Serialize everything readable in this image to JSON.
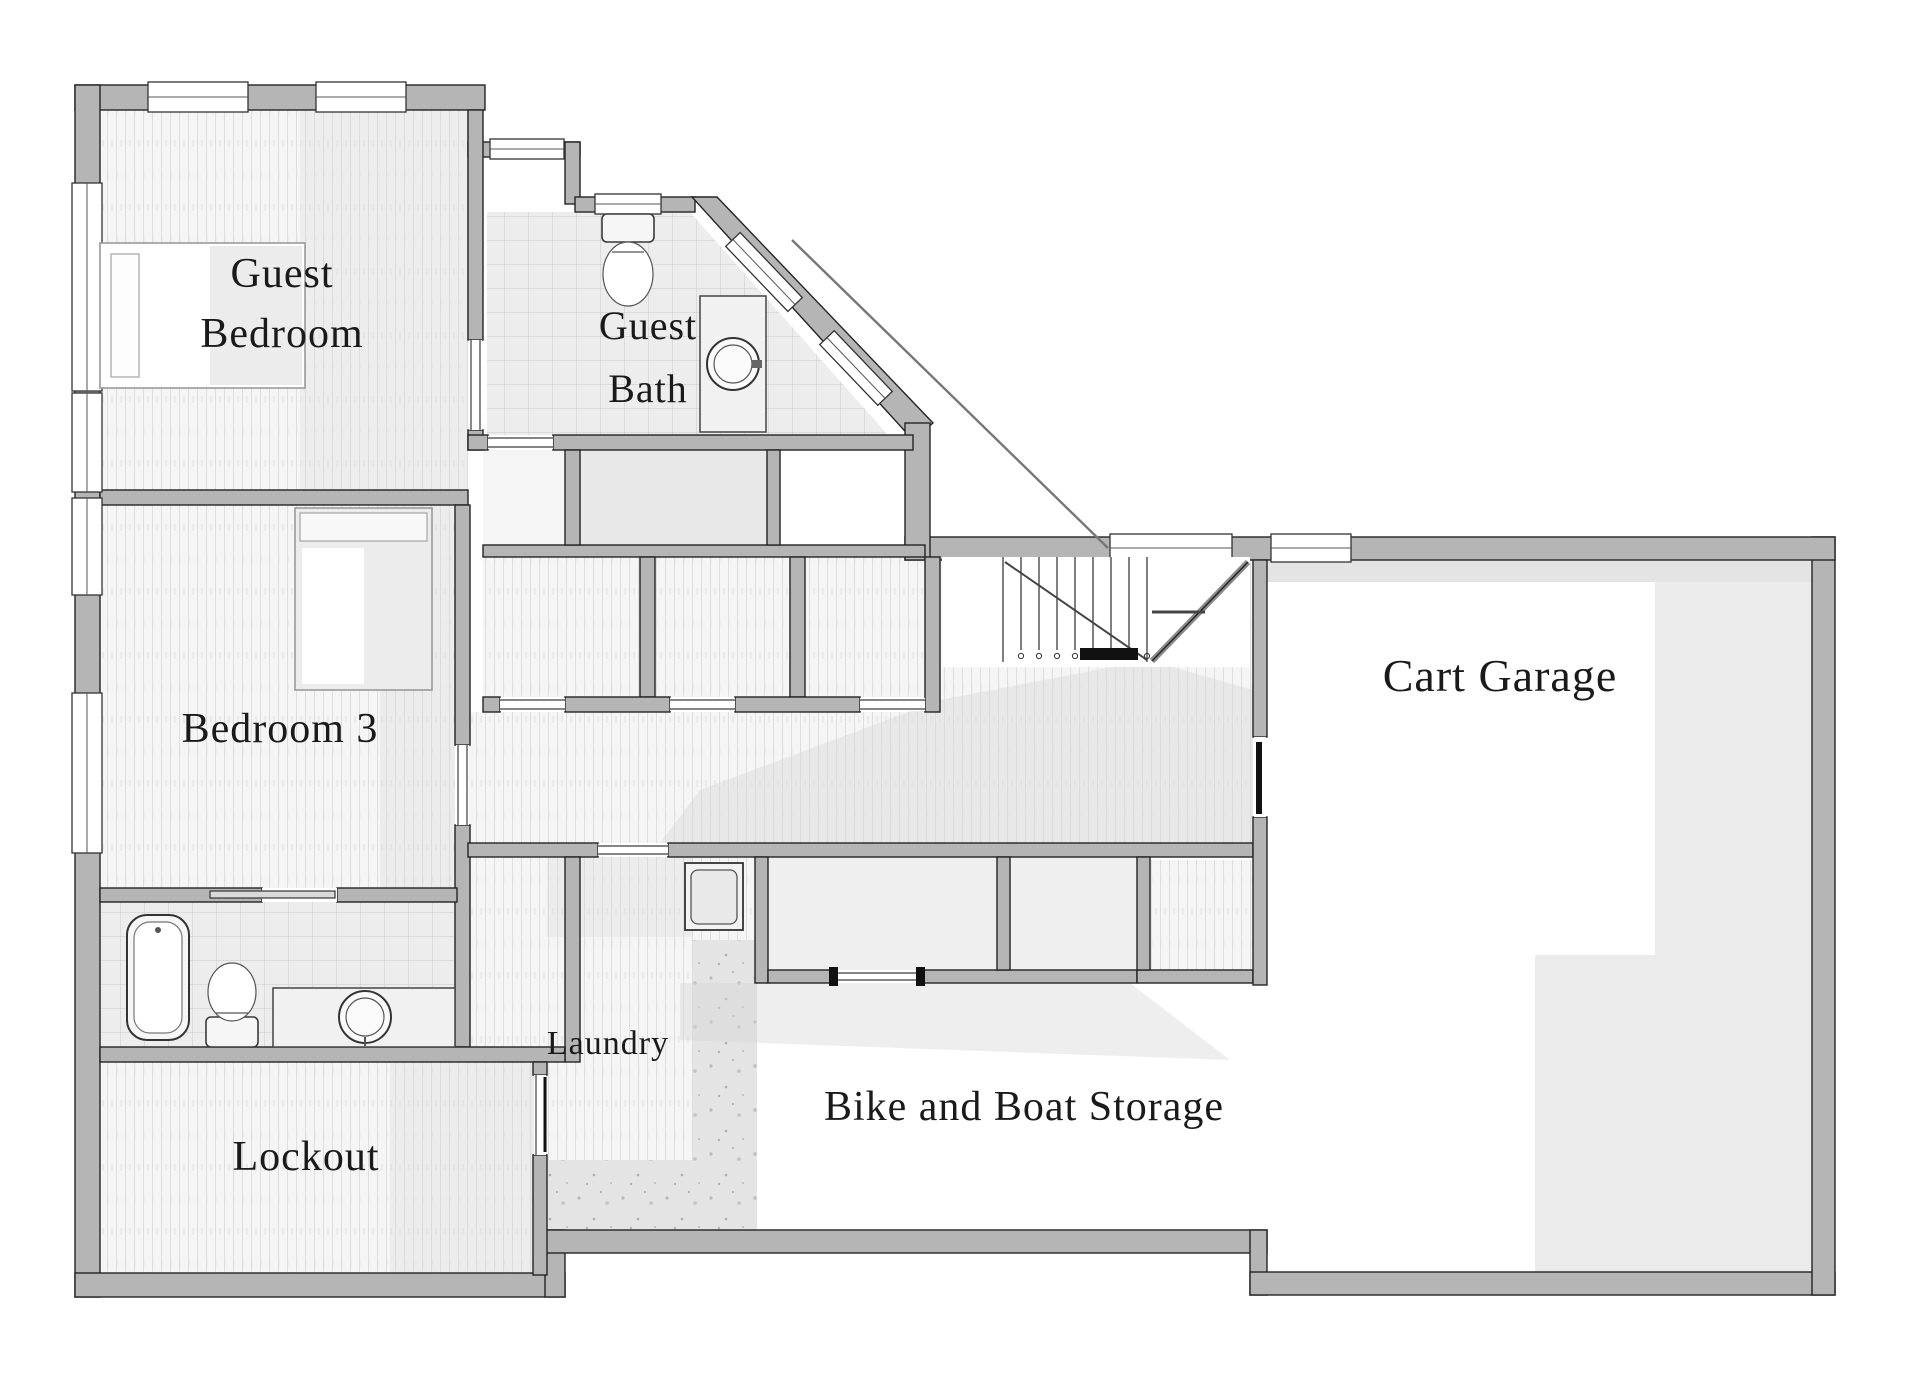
{
  "plan": {
    "type": "floor-plan",
    "level": "lower-level"
  },
  "rooms": {
    "guest_bedroom": {
      "label_line1": "Guest",
      "label_line2": "Bedroom"
    },
    "guest_bath": {
      "label_line1": "Guest",
      "label_line2": "Bath"
    },
    "bedroom_3": {
      "label": "Bedroom 3"
    },
    "lockout": {
      "label": "Lockout"
    },
    "laundry": {
      "label": "Laundry"
    },
    "bike_boat_storage": {
      "label": "Bike and Boat Storage"
    },
    "cart_garage": {
      "label": "Cart Garage"
    }
  },
  "colors": {
    "wall": "#b5b5b5",
    "wall_outline": "#242424",
    "floor_wood_base": "#f5f5f5",
    "floor_wood_stripe": "#dedede",
    "floor_tile": "#ededed",
    "tile_grid": "#c9c9c9",
    "floor_closet_gray": "#e8e8e8",
    "floor_garage": "#ebebeb",
    "floor_concrete": "#e4e4e4",
    "label_text": "#1a1a1a",
    "background": "#ffffff"
  }
}
